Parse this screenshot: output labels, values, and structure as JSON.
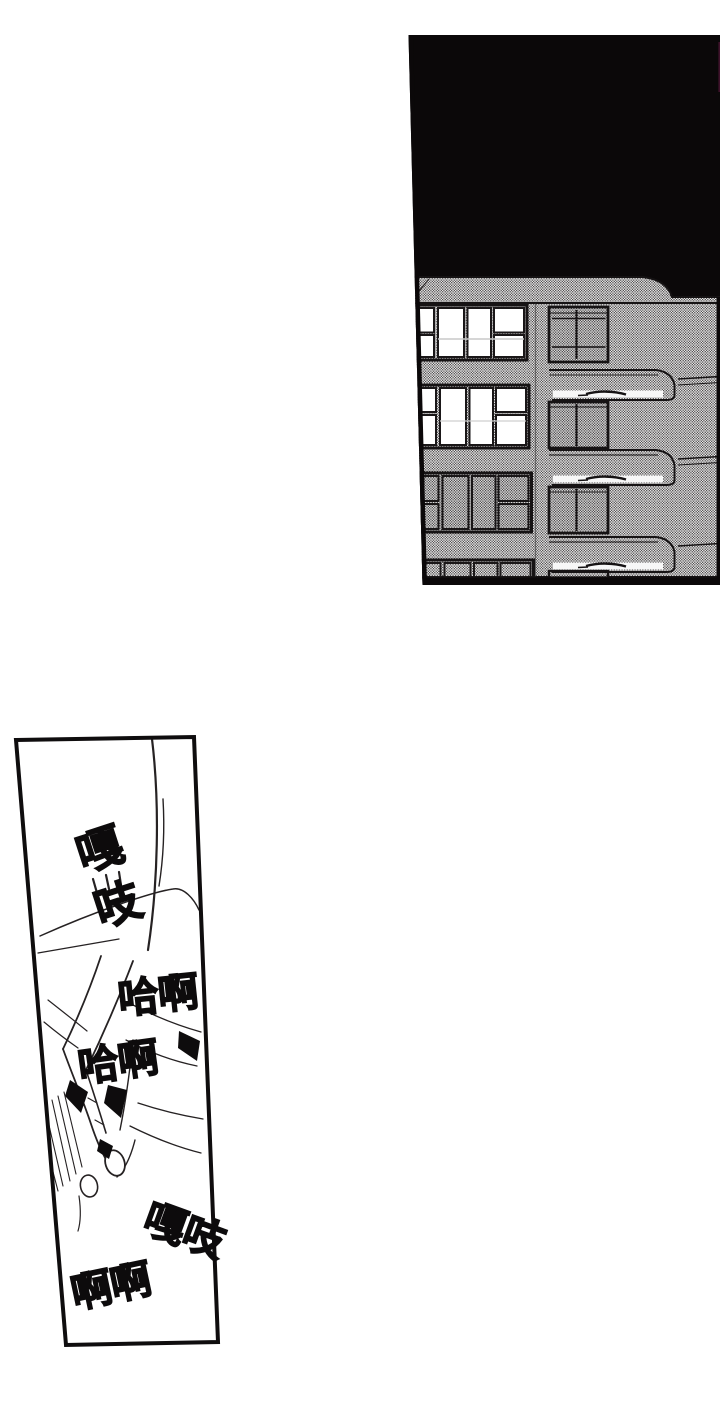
{
  "colors": {
    "paper": "#ffffff",
    "ink": "#0d0b0c",
    "night_sky": "#0b0809",
    "screentone_average": "#b0b0b0",
    "window_lit": "#ffffff"
  },
  "sfx": [
    {
      "text": "嘎吱"
    },
    {
      "text": "哈啊"
    },
    {
      "text": "哈啊"
    },
    {
      "text": "嘎吱"
    },
    {
      "text": "啊啊"
    }
  ]
}
